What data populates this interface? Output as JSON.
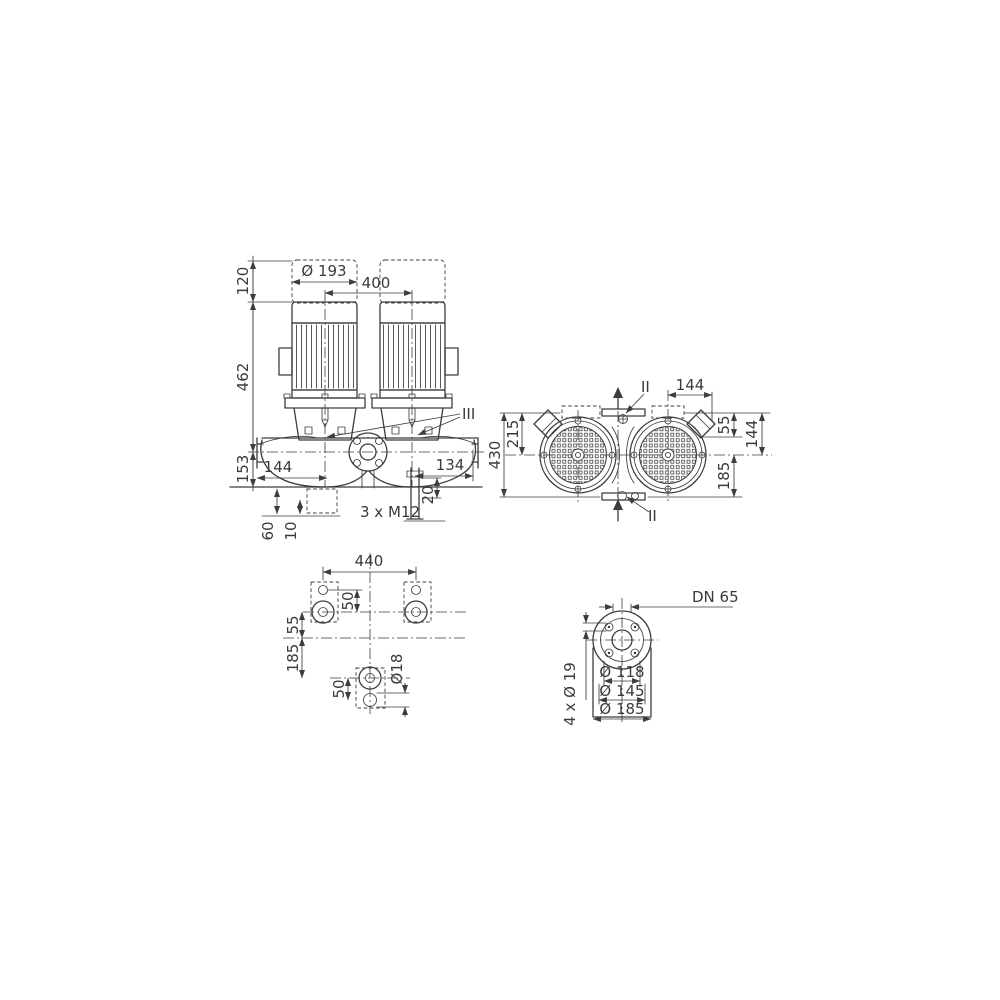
{
  "front_view": {
    "dim_120": "120",
    "dim_462": "462",
    "dim_153": "153",
    "dim_dia193": "Ø 193",
    "dim_400": "400",
    "dim_144": "144",
    "dim_134": "134",
    "dim_20": "20",
    "dim_3xm12": "3 x M12",
    "dim_60": "60",
    "dim_10": "10",
    "label_iii": "III"
  },
  "top_view": {
    "dim_430": "430",
    "dim_215": "215",
    "dim_144_top": "144",
    "dim_55": "55",
    "dim_144_side": "144",
    "dim_185": "185",
    "label_ii_top": "II",
    "label_ii_bottom": "II"
  },
  "foundation_view": {
    "dim_440": "440",
    "dim_50_top": "50",
    "dim_55": "55",
    "dim_185": "185",
    "dim_50_bottom": "50",
    "dim_dia18": "Ø18"
  },
  "flange_view": {
    "label_dn": "DN 65",
    "dim_dia118": "Ø 118",
    "dim_dia145": "Ø 145",
    "dim_dia185": "Ø 185",
    "dim_4x_dia19": "4 x Ø 19"
  },
  "colors": {
    "line": "#3d3d3d",
    "text": "#3a3a3a",
    "background": "#ffffff"
  }
}
